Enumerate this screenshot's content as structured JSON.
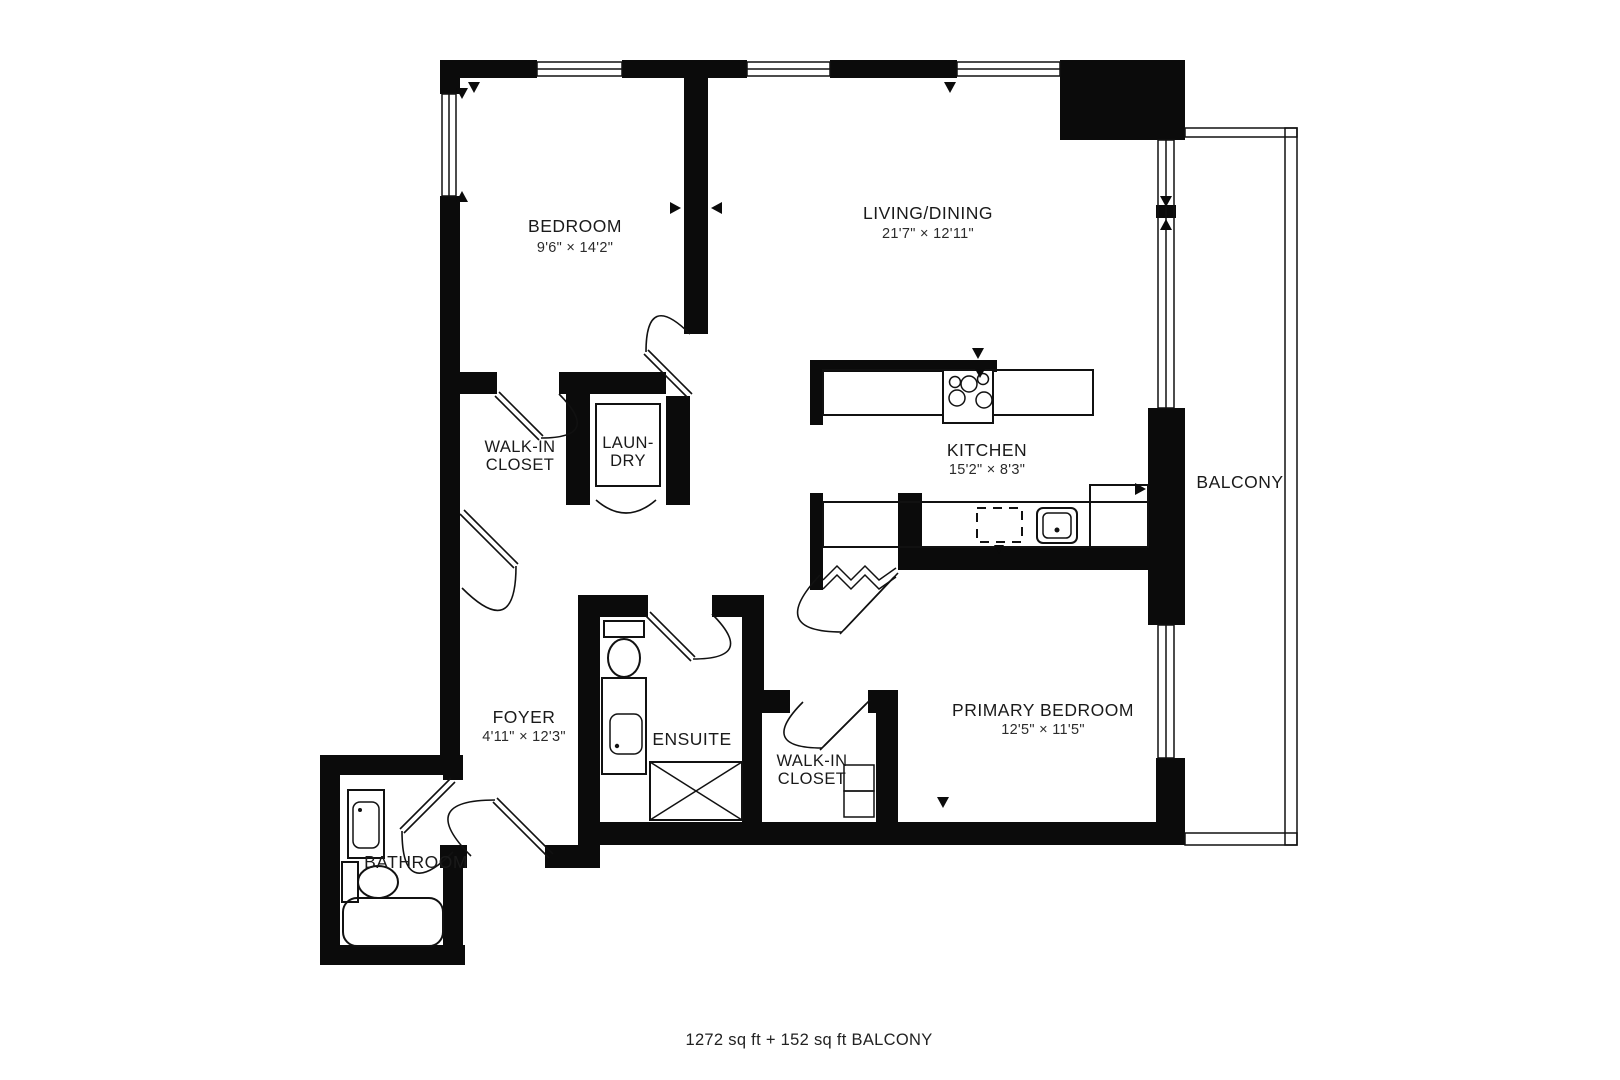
{
  "plan": {
    "rooms": {
      "bedroom": {
        "label": "BEDROOM",
        "dims": "9'6\" × 14'2\""
      },
      "living_dining": {
        "label": "LIVING/DINING",
        "dims": "21'7\" × 12'11\""
      },
      "walk_in_closet_1": {
        "line1": "WALK-IN",
        "line2": "CLOSET"
      },
      "laundry": {
        "line1": "LAUN-",
        "line2": "DRY"
      },
      "kitchen": {
        "label": "KITCHEN",
        "dims": "15'2\" × 8'3\""
      },
      "balcony": {
        "label": "BALCONY"
      },
      "foyer": {
        "label": "FOYER",
        "dims": "4'11\" × 12'3\""
      },
      "ensuite": {
        "label": "ENSUITE"
      },
      "walk_in_closet_2": {
        "line1": "WALK-IN",
        "line2": "CLOSET"
      },
      "primary_bedroom": {
        "label": "PRIMARY BEDROOM",
        "dims": "12'5\" × 11'5\""
      },
      "bathroom": {
        "label": "BATHROOM"
      }
    },
    "footer": {
      "area_text": "1272 sq ft + 152 sq ft BALCONY"
    },
    "colors": {
      "walls": "#0b0b0b",
      "lines": "#111111",
      "background": "#ffffff"
    }
  }
}
